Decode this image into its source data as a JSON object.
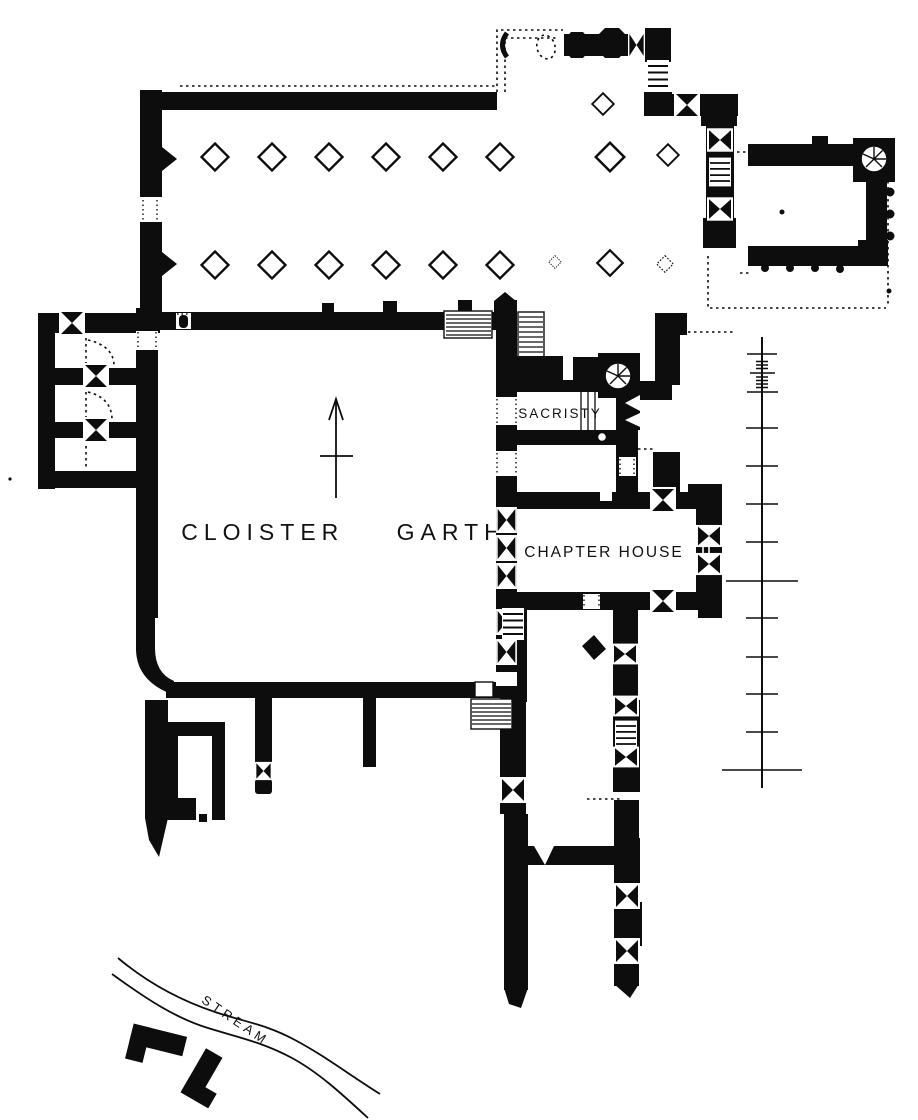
{
  "plan": {
    "labels": {
      "cloister_garth": "CLOISTER GARTH",
      "sacristy": "SACRISTY",
      "chapter_house": "CHAPTER HOUSE",
      "stream": "STREAM"
    },
    "colors": {
      "ink": "#0d0d0d",
      "paper": "#ffffff"
    }
  }
}
